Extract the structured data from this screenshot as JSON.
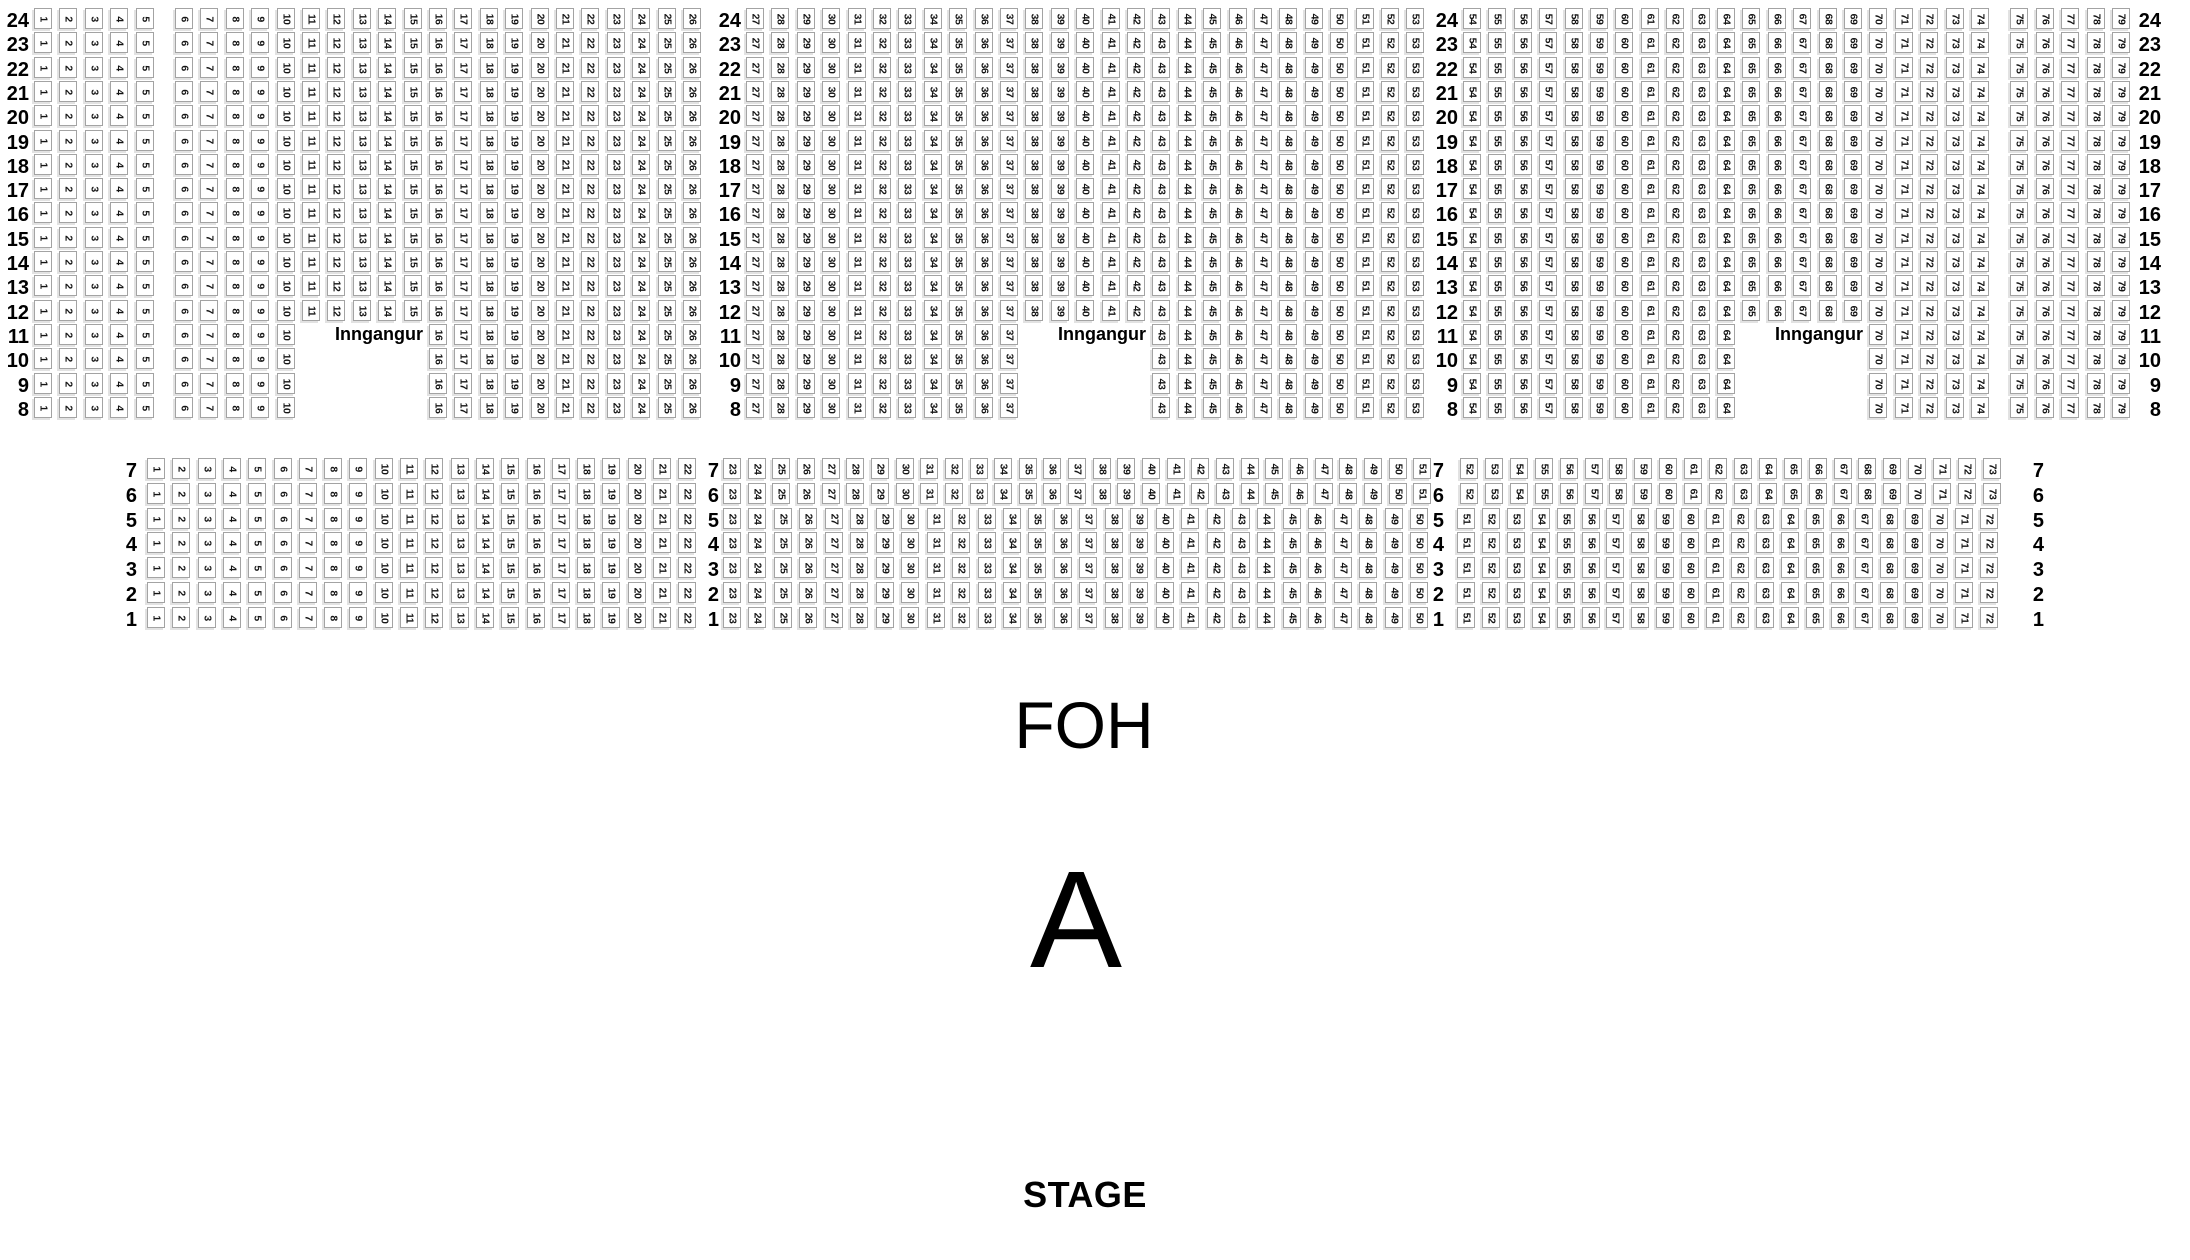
{
  "canvas": {
    "width": 2190,
    "height": 1260,
    "background": "#ffffff"
  },
  "colors": {
    "seat_fill": "#ffffff",
    "seat_border": "#a3a3a3",
    "seat_shadow": "#e2e2e2",
    "text": "#000000"
  },
  "labels": {
    "entrance": "Inngangur",
    "foh": "FOH",
    "section_letter": "A",
    "stage": "STAGE"
  },
  "top_section": {
    "rows": {
      "from": 24,
      "to": 8
    },
    "y0": 8,
    "row_pitch": 24.3,
    "row_label_columns": [
      {
        "x_right": 29
      },
      {
        "x_right": 741
      },
      {
        "x_right": 1458
      },
      {
        "x_right": 2161
      }
    ],
    "blocks": [
      {
        "name": "left",
        "x0": 34,
        "pitch": 25.4,
        "seats": {
          "from": 1,
          "to": 26
        },
        "extra_gap_after": {
          "5": 14
        },
        "entrance_gap": {
          "rows_from": 11,
          "rows_to": 8,
          "seats_from": 11,
          "seats_to": 15
        },
        "entrance_label_row": 11
      },
      {
        "name": "middle",
        "x0": 746,
        "pitch": 25.4,
        "seats": {
          "from": 27,
          "to": 53
        },
        "extra_gap_after": {},
        "entrance_gap": {
          "rows_from": 11,
          "rows_to": 8,
          "seats_from": 38,
          "seats_to": 42
        },
        "entrance_label_row": 11
      },
      {
        "name": "right",
        "x0": 1463,
        "pitch": 25.4,
        "seats": {
          "from": 54,
          "to": 79
        },
        "extra_gap_after": {
          "74": 14
        },
        "entrance_gap": {
          "rows_from": 11,
          "rows_to": 8,
          "seats_from": 65,
          "seats_to": 69
        },
        "entrance_label_row": 11
      }
    ]
  },
  "bottom_section": {
    "rows": {
      "from": 7,
      "to": 1
    },
    "y0": 458,
    "row_pitch": 24.8,
    "row_label_columns": [
      {
        "x_right": 137
      },
      {
        "x_right": 719
      },
      {
        "x_right": 1444
      },
      {
        "x_right": 2044
      }
    ],
    "blocks": [
      {
        "name": "left",
        "rows": {
          "from": 7,
          "to": 1
        },
        "x0": 147,
        "pitch": 25.3,
        "seats": {
          "from": 1,
          "to": 22
        },
        "extra_gap_after": {}
      },
      {
        "name": "middle-upper",
        "rows": {
          "from": 7,
          "to": 6
        },
        "x0": 723,
        "pitch": 24.65,
        "seats": {
          "from": 23,
          "to": 51
        },
        "extra_gap_after": {}
      },
      {
        "name": "middle-lower",
        "rows": {
          "from": 5,
          "to": 1
        },
        "x0": 723,
        "pitch": 25.45,
        "seats": {
          "from": 23,
          "to": 50
        },
        "extra_gap_after": {}
      },
      {
        "name": "right-upper",
        "rows": {
          "from": 7,
          "to": 6
        },
        "x0": 1460,
        "pitch": 24.9,
        "seats": {
          "from": 52,
          "to": 73
        },
        "extra_gap_after": {}
      },
      {
        "name": "right-lower",
        "rows": {
          "from": 5,
          "to": 1
        },
        "x0": 1457,
        "pitch": 24.9,
        "seats": {
          "from": 51,
          "to": 72
        },
        "extra_gap_after": {}
      }
    ]
  }
}
